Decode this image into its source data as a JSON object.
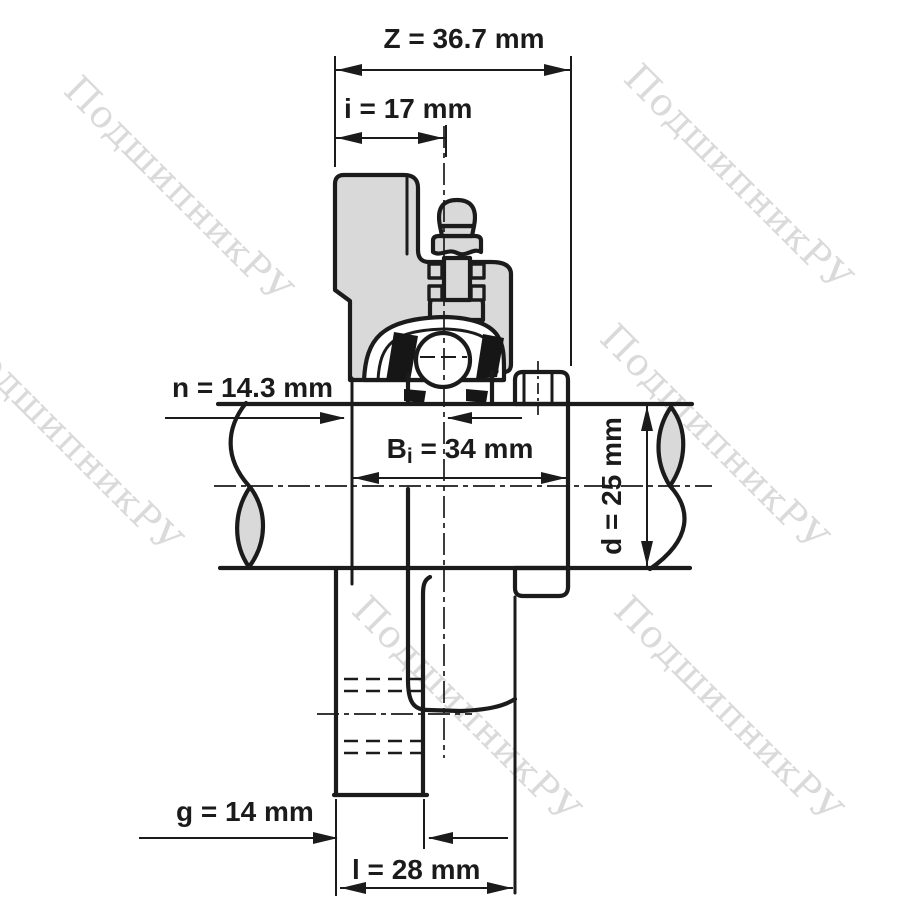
{
  "drawing": {
    "description": "Flanged bearing unit with shaft - dimensioned cross-section drawing",
    "watermark": "ПодшипникРУ",
    "colors": {
      "line": "#1b1b1b",
      "metal_fill": "#d9d9d9",
      "watermark": "#d2d2d2",
      "background": "#ffffff"
    },
    "dimensions": {
      "z": "Z = 36.7 mm",
      "i": "i = 17 mm",
      "n": "n = 14.3 mm",
      "bi_prefix": "B",
      "bi_sub": "i",
      "bi_suffix": " = 34 mm",
      "d": "d = 25 mm",
      "g": "g = 14 mm",
      "l": "l = 28 mm"
    }
  }
}
